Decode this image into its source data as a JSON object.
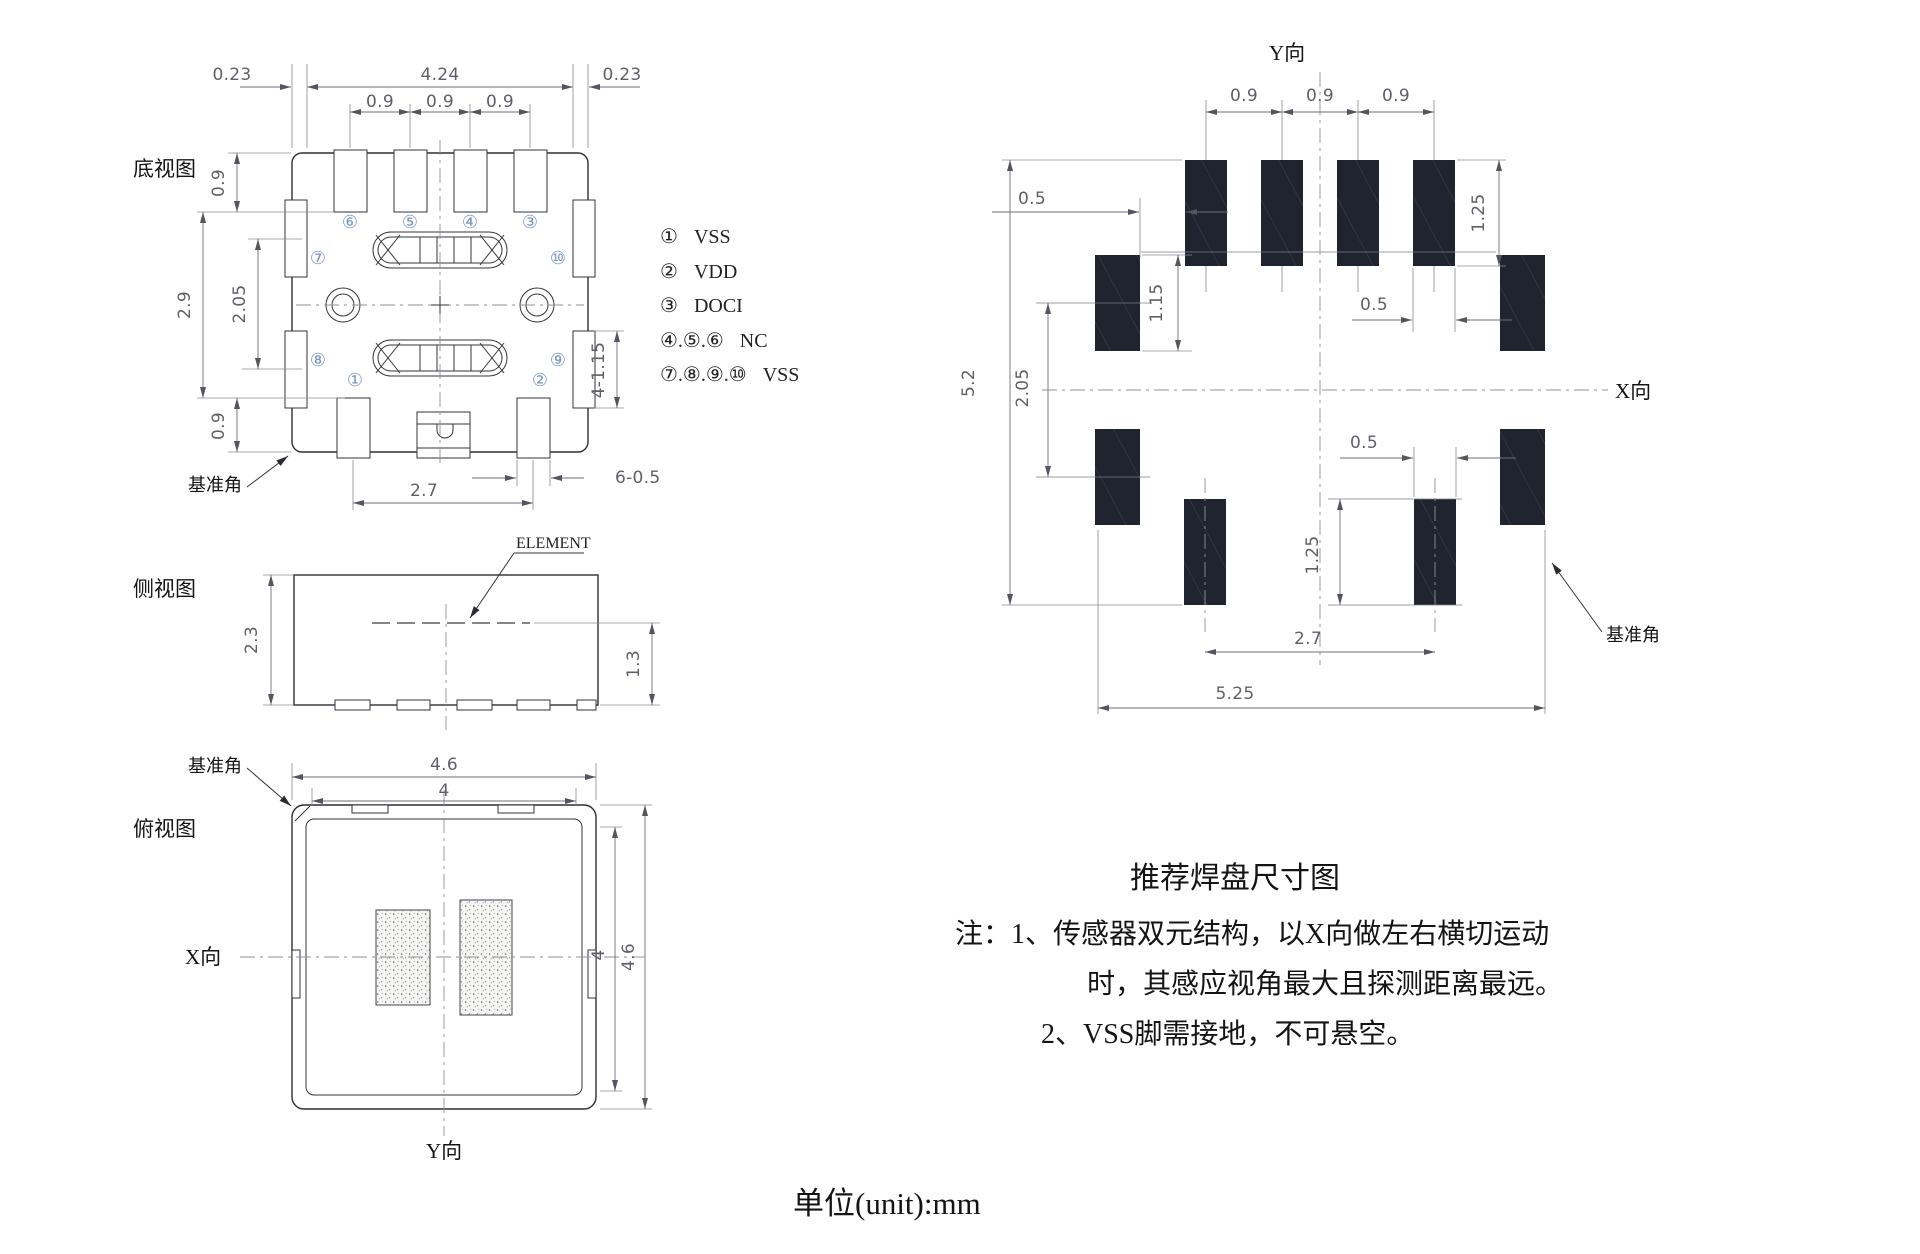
{
  "bottom_view": {
    "label": "底视图",
    "datum": "基准角",
    "dim_023_left": "0.23",
    "dim_424": "4.24",
    "dim_023_right": "0.23",
    "dim_09_a": "0.9",
    "dim_09_b": "0.9",
    "dim_09_c": "0.9",
    "dim_09_top": "0.9",
    "dim_29": "2.9",
    "dim_205": "2.05",
    "dim_09_bottom": "0.9",
    "dim_4_115": "4-1.15",
    "dim_6_05": "6-0.5",
    "dim_27": "2.7",
    "pin1": "①",
    "pin2": "②",
    "pin3": "③",
    "pin4": "④",
    "pin5": "⑤",
    "pin6": "⑥",
    "pin7": "⑦",
    "pin8": "⑧",
    "pin9": "⑨",
    "pin10": "⑩"
  },
  "pin_definitions": {
    "rows": [
      {
        "nums": "①",
        "signal": "VSS"
      },
      {
        "nums": "②",
        "signal": "VDD"
      },
      {
        "nums": "③",
        "signal": "DOCI"
      },
      {
        "nums": "④.⑤.⑥",
        "signal": "NC"
      },
      {
        "nums": "⑦.⑧.⑨.⑩",
        "signal": "VSS"
      }
    ]
  },
  "side_view": {
    "label": "侧视图",
    "element_label": "ELEMENT",
    "dim_23": "2.3",
    "dim_13": "1.3"
  },
  "top_view": {
    "label": "俯视图",
    "datum": "基准角",
    "x_axis": "X向",
    "y_axis": "Y向",
    "dim_46_top": "4.6",
    "dim_4_top": "4",
    "dim_4_right": "4",
    "dim_46_right": "4.6"
  },
  "pad_layout": {
    "y_axis": "Y向",
    "x_axis": "X向",
    "datum": "基准角",
    "dim_09_a": "0.9",
    "dim_09_b": "0.9",
    "dim_09_c": "0.9",
    "dim_05_upper": "0.5",
    "dim_125_top": "1.25",
    "dim_115": "1.15",
    "dim_05_mid": "0.5",
    "dim_52": "5.2",
    "dim_205": "2.05",
    "dim_05_lower": "0.5",
    "dim_125_bottom": "1.25",
    "dim_27": "2.7",
    "dim_525": "5.25"
  },
  "notes": {
    "title": "推荐焊盘尺寸图",
    "line1": "注：1、传感器双元结构，以X向做左右横切运动",
    "line2": "时，其感应视角最大且探测距离最远。",
    "line3": "2、VSS脚需接地，不可悬空。"
  },
  "footer": {
    "unit_label": "单位(unit):mm"
  },
  "colors": {
    "pad_fill": "#20242e",
    "outline": "#2e2e36",
    "dim": "#6e6e78"
  }
}
